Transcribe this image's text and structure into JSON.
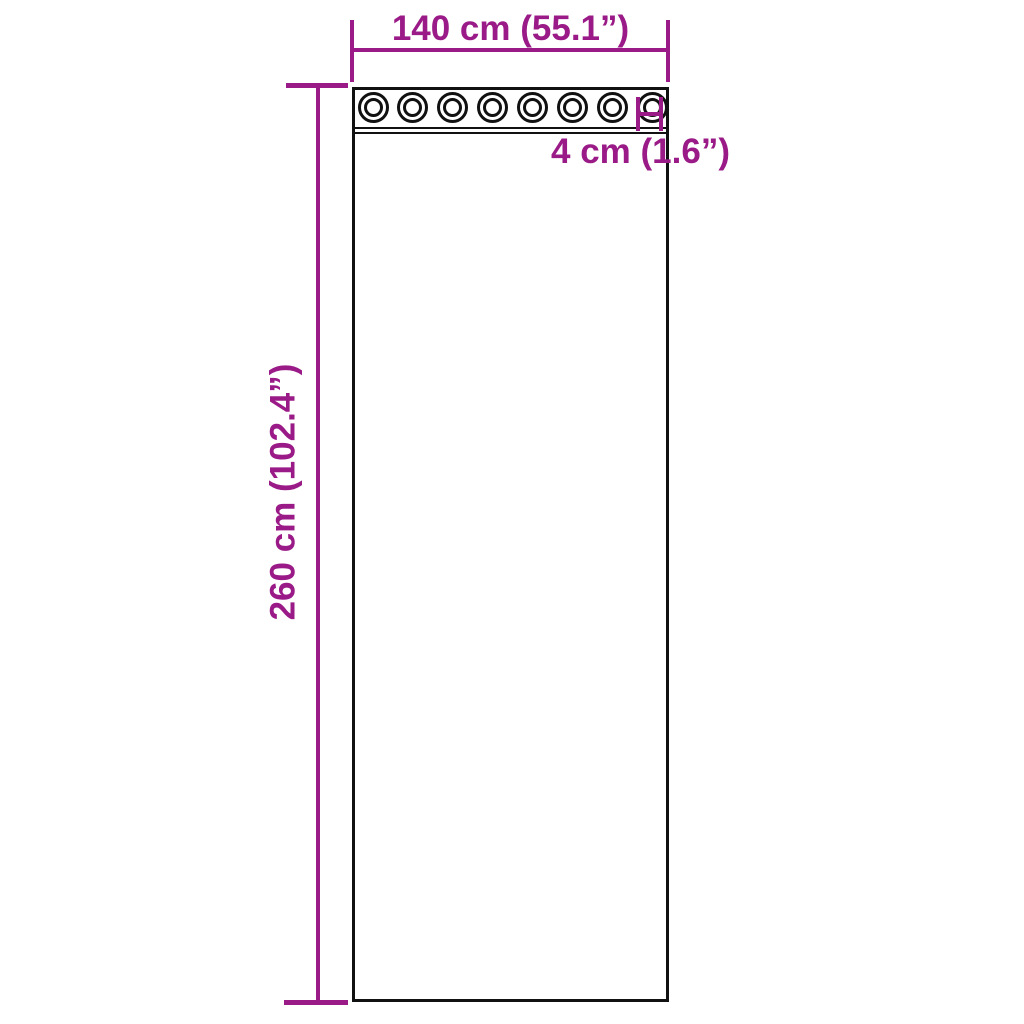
{
  "diagram": {
    "kind": "product-dimension-diagram",
    "subject": "curtain panel with grommets",
    "width_dimension": {
      "label": "140 cm (55.1”)"
    },
    "height_dimension": {
      "label": "260 cm (102.4”)"
    },
    "grommet_dimension": {
      "label": "4 cm (1.6”)"
    },
    "grommet_count": 8,
    "colors": {
      "dimension_accent": "#9a1b87",
      "outline": "#111111",
      "background": "#ffffff"
    }
  }
}
